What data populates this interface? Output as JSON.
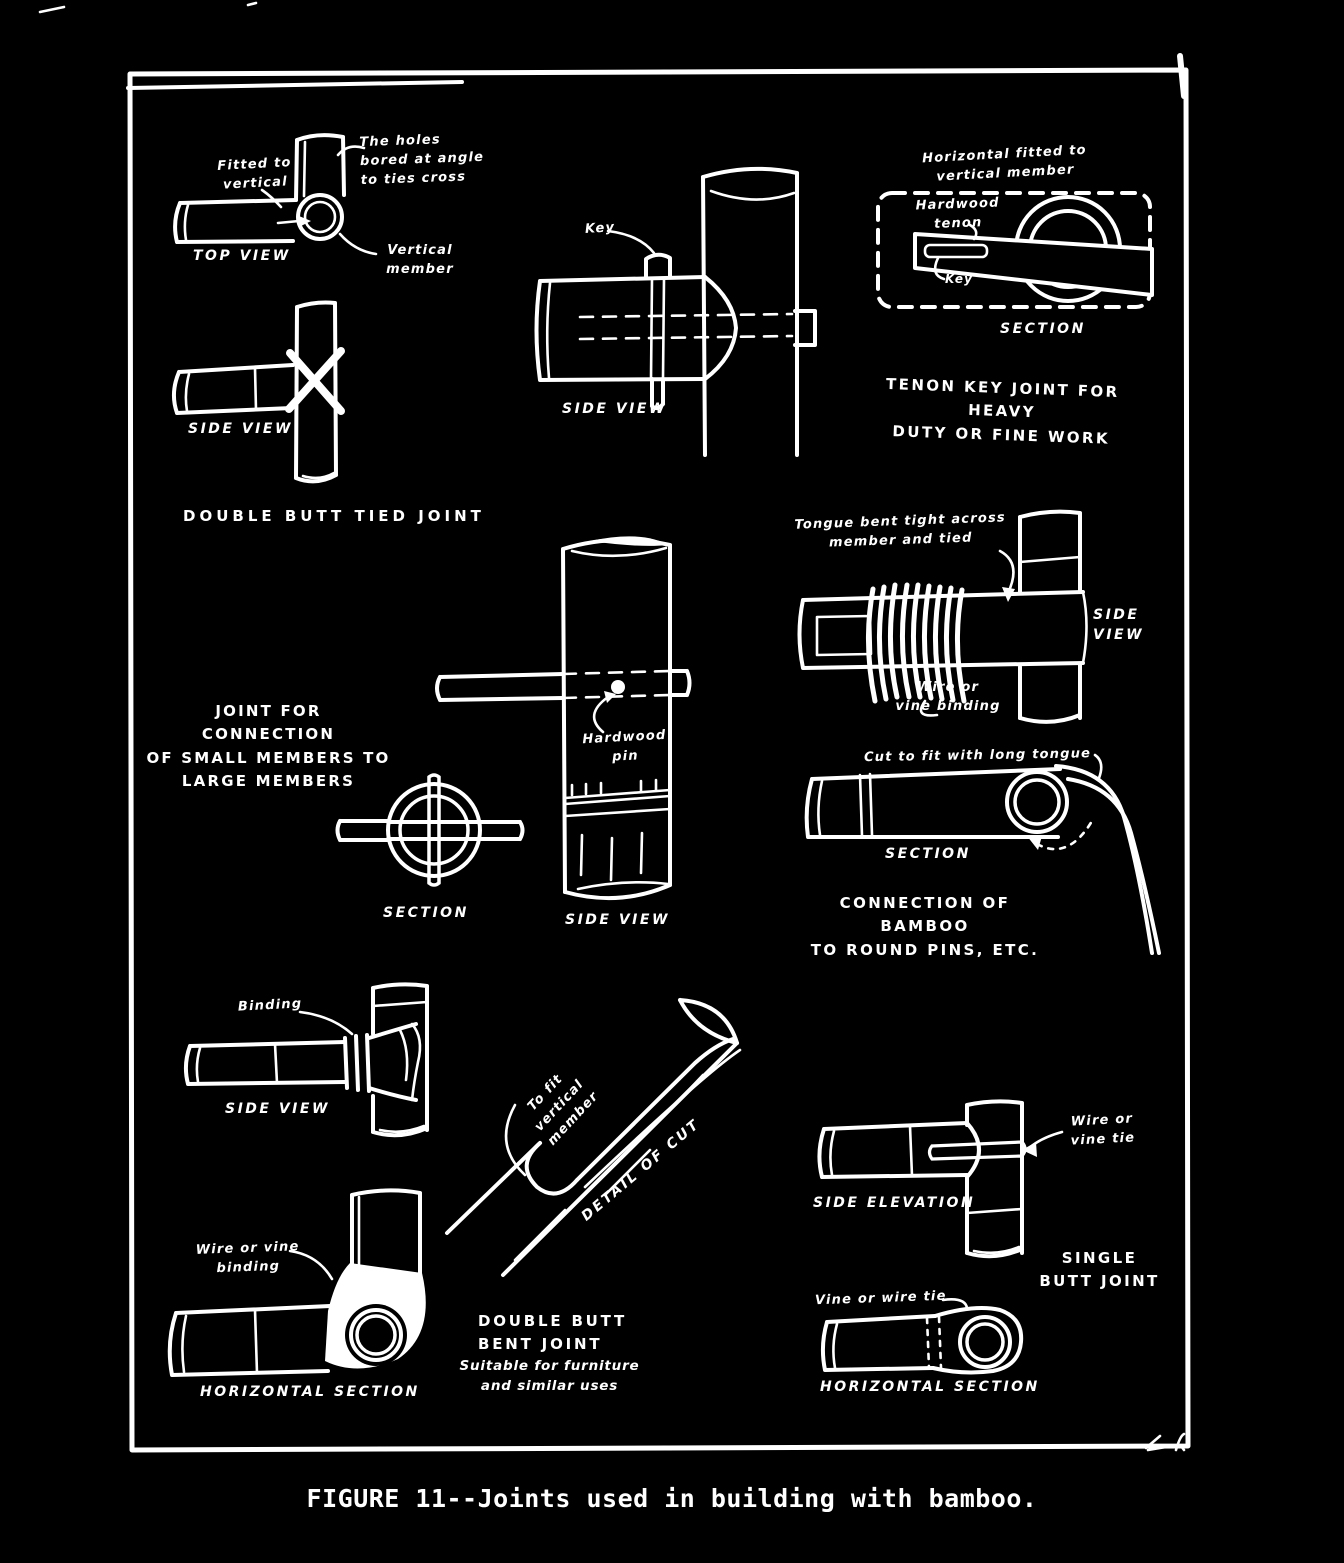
{
  "page": {
    "ink_color": "#ffffff",
    "bg_color": "#000000",
    "caption": "FIGURE 11--Joints used in building with bamboo."
  },
  "tied_joint": {
    "ann_fitted": "Fitted to\nvertical",
    "ann_holes": "The holes\nbored at angle\nto ties cross",
    "top_view_label": "TOP VIEW",
    "ann_vertical_member": "Vertical\nmember",
    "side_view_label": "SIDE VIEW",
    "title": "DOUBLE BUTT TIED JOINT"
  },
  "key_joint": {
    "ann_key": "Key",
    "side_view_label": "SIDE VIEW"
  },
  "tenon_joint": {
    "ann_horizontal": "Horizontal fitted to\nvertical member",
    "ann_tenon": "Hardwood\ntenon",
    "ann_key": "Key",
    "section_label": "SECTION",
    "title": "TENON KEY JOINT FOR HEAVY\nDUTY OR FINE WORK"
  },
  "small_members_joint": {
    "title": "JOINT FOR CONNECTION\nOF SMALL MEMBERS TO\nLARGE MEMBERS",
    "ann_pin": "Hardwood\npin",
    "section_label": "SECTION",
    "side_view_label": "SIDE VIEW"
  },
  "tongue_joint": {
    "ann_tongue": "Tongue bent tight across\nmember and tied",
    "side_view_label": "SIDE\nVIEW",
    "ann_wire": "Wire or\nvine binding"
  },
  "round_pins_joint": {
    "ann_cut": "Cut to fit with long tongue",
    "section_label": "SECTION",
    "title": "CONNECTION OF BAMBOO\nTO ROUND PINS, ETC."
  },
  "binding_joint": {
    "ann_binding": "Binding",
    "side_view_label": "SIDE VIEW",
    "ann_wire": "Wire or vine\nbinding",
    "horizontal_section_label": "HORIZONTAL SECTION"
  },
  "bent_joint": {
    "ann_fit": "To fit\nvertical\nmember",
    "detail_label": "DETAIL OF CUT",
    "title": "DOUBLE BUTT\nBENT JOINT",
    "subtitle": "Suitable for furniture\nand similar uses"
  },
  "single_butt_joint": {
    "ann_wire_tie": "Wire or\nvine tie",
    "side_elevation_label": "SIDE ELEVATION",
    "title": "SINGLE\nBUTT JOINT",
    "ann_vine_tie": "Vine or wire tie",
    "horizontal_section_label": "HORIZONTAL SECTION"
  }
}
